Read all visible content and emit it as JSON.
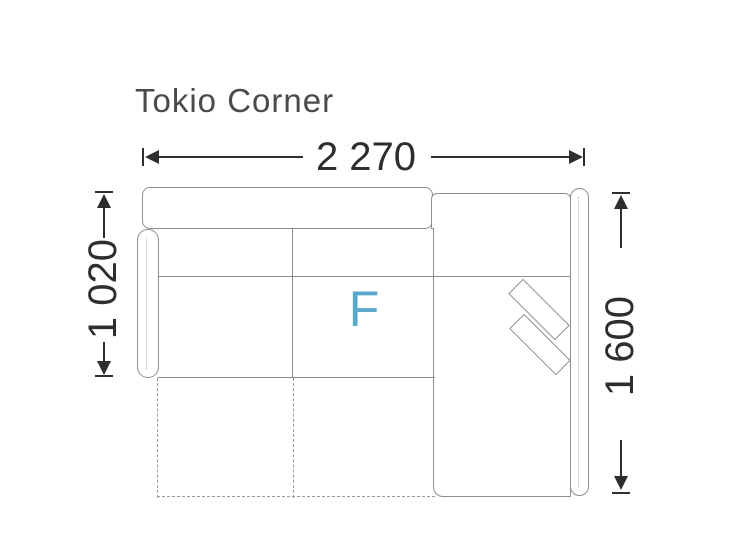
{
  "title": "Tokio Corner",
  "dimensions": {
    "overall_width": "2 270",
    "seat_depth": "1 020",
    "chaise_depth": "1 600"
  },
  "labels": {
    "seat_marker": "F"
  },
  "colors": {
    "marker_accent": "#58a9cb",
    "sofa_outline": "#8e8e8e",
    "dimension_ink": "#2e2e2e",
    "bed_extension_dash": "#999999",
    "background": "#ffffff"
  }
}
